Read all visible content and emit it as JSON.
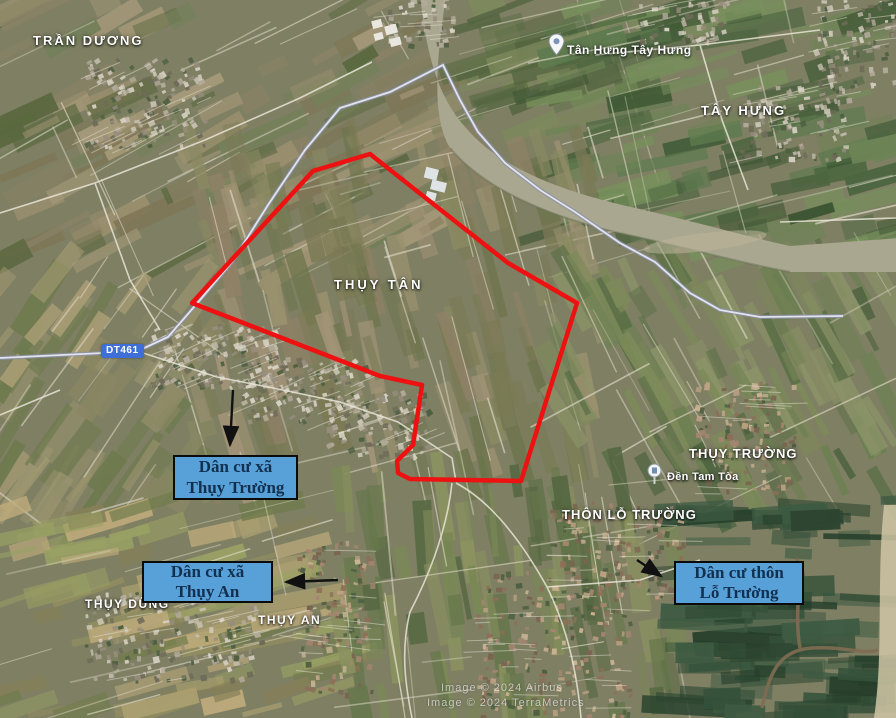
{
  "map": {
    "labels": {
      "tran_duong": "TRẦN DƯƠNG",
      "tan_hung_tay_hung": "Tân Hưng Tây Hưng",
      "tay_hung": "TÂY HƯNG",
      "thuy_tan": "THỤY TÂN",
      "thuy_truong": "THỤY TRƯỜNG",
      "den_tam_toa": "Đền Tam Tòa",
      "thon_lo_truong": "THÔN LỖ TRƯỜNG",
      "thuy_dung": "THỤY DŨNG",
      "thuy_an": "THỤY AN"
    },
    "road_badge": "DT461",
    "annotations": [
      {
        "line1": "Dân cư xã",
        "line2": "Thụy Trường"
      },
      {
        "line1": "Dân cư xã",
        "line2": "Thụy An"
      },
      {
        "line1": "Dân cư thôn",
        "line2": "Lỗ Trường"
      }
    ],
    "watermark": {
      "line1": "Image © 2024 Airbus",
      "line2": "Image © 2024 TerraMetrics"
    },
    "colors": {
      "boundary_red": "#ee1111",
      "annotation_fill": "#58a0d8",
      "annotation_border": "#0b0b0b",
      "annotation_text": "#12304f",
      "road_badge_fill": "#3e6fd6",
      "label_text": "#ffffff"
    }
  }
}
